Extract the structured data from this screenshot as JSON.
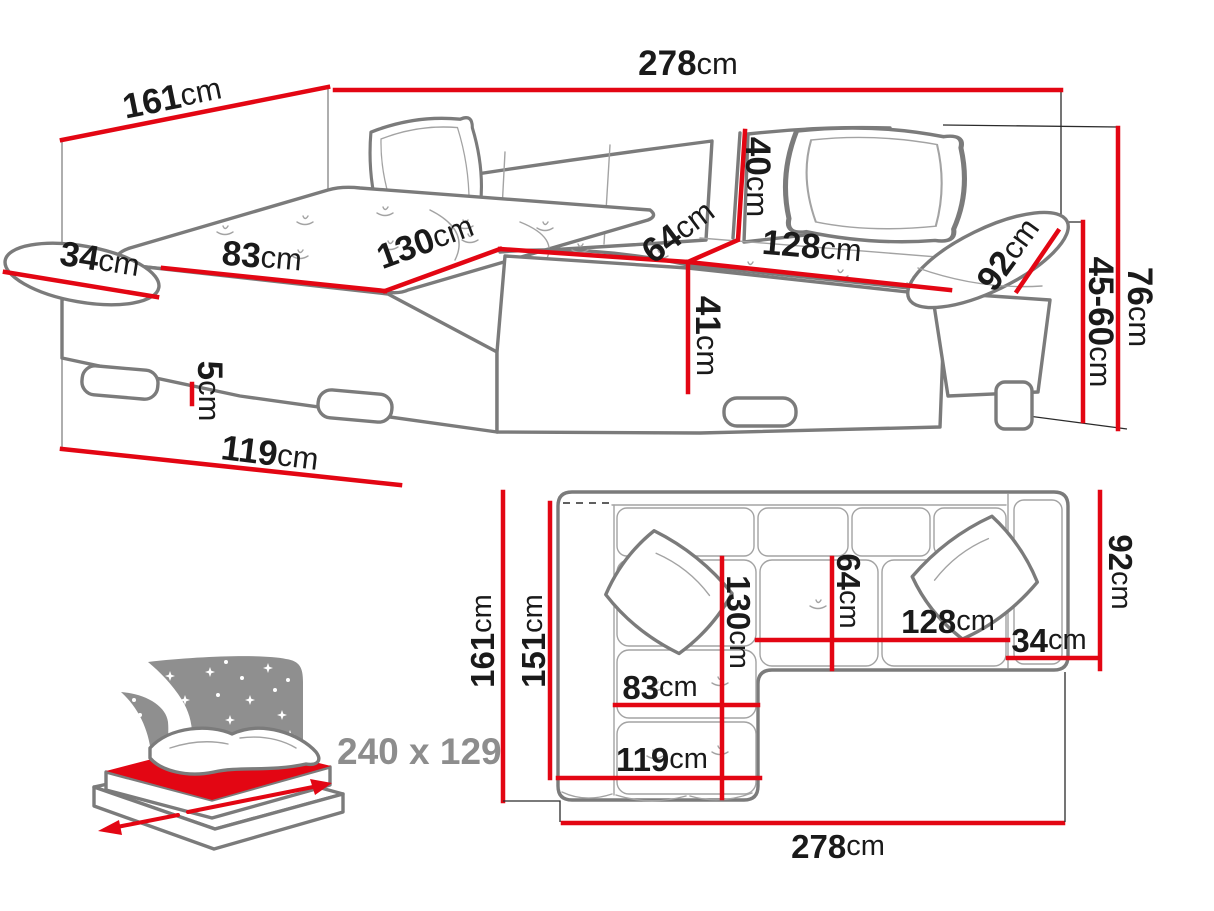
{
  "title": "Corner sofa bed dimensions diagram",
  "colors": {
    "dimension_red": "#e30613",
    "sketch_gray": "#7b7b7b",
    "text_black": "#1a1a1a",
    "icon_gray": "#8d8d8d"
  },
  "perspective_view": {
    "dimensions": {
      "back_width": {
        "value": "161",
        "unit": "cm"
      },
      "total_width": {
        "value": "278",
        "unit": "cm"
      },
      "armrest_left_depth": {
        "value": "34",
        "unit": "cm"
      },
      "chaise_seat_width": {
        "value": "83",
        "unit": "cm"
      },
      "chaise_length": {
        "value": "130",
        "unit": "cm"
      },
      "backrest_height": {
        "value": "40",
        "unit": "cm"
      },
      "seat_depth": {
        "value": "64",
        "unit": "cm"
      },
      "seat_length": {
        "value": "128",
        "unit": "cm"
      },
      "armrest_right_length": {
        "value": "92",
        "unit": "cm"
      },
      "seat_height": {
        "value": "45-60",
        "unit": "cm"
      },
      "total_height": {
        "value": "76",
        "unit": "cm"
      },
      "base_height": {
        "value": "41",
        "unit": "cm"
      },
      "leg_height": {
        "value": "5",
        "unit": "cm"
      },
      "chaise_front_width": {
        "value": "119",
        "unit": "cm"
      }
    }
  },
  "plan_view": {
    "dimensions": {
      "depth_total": {
        "value": "161",
        "unit": "cm"
      },
      "depth_inner": {
        "value": "151",
        "unit": "cm"
      },
      "chaise_length": {
        "value": "130",
        "unit": "cm"
      },
      "seat_depth": {
        "value": "64",
        "unit": "cm"
      },
      "chaise_seat_width": {
        "value": "83",
        "unit": "cm"
      },
      "chaise_front_width": {
        "value": "119",
        "unit": "cm"
      },
      "seat_length": {
        "value": "128",
        "unit": "cm"
      },
      "armrest_width": {
        "value": "34",
        "unit": "cm"
      },
      "side_depth": {
        "value": "92",
        "unit": "cm"
      },
      "total_width": {
        "value": "278",
        "unit": "cm"
      }
    }
  },
  "sleeping_function": {
    "bed_size": "240 x 129"
  }
}
